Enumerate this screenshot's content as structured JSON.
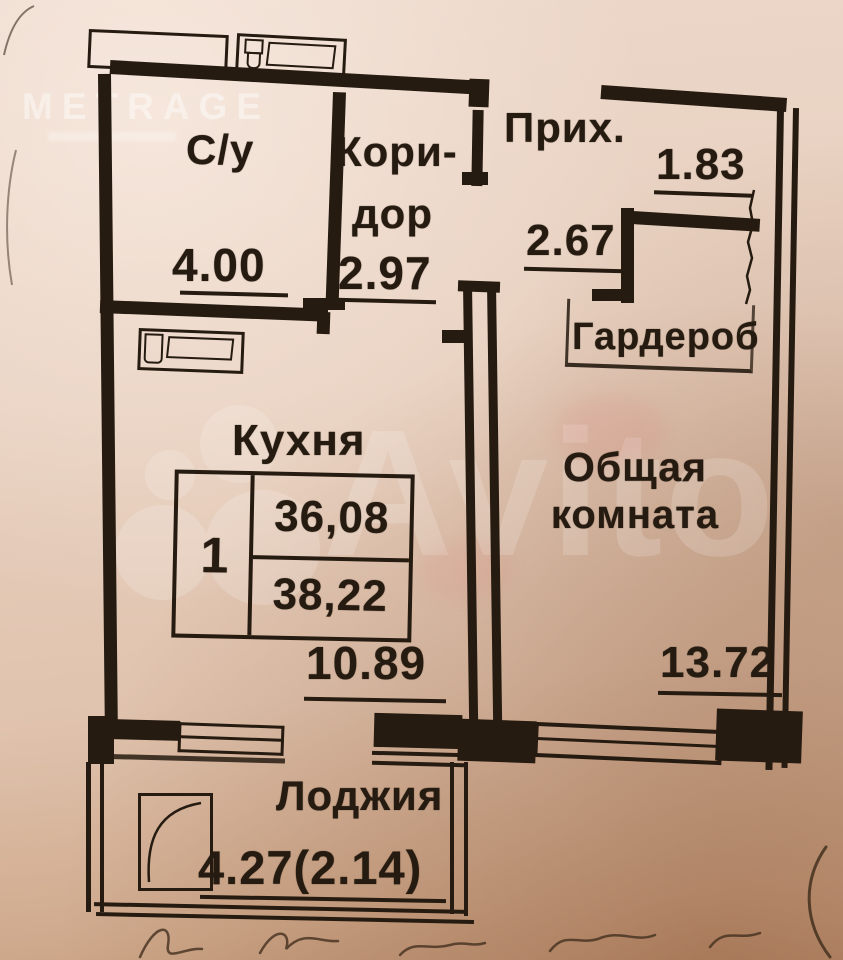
{
  "watermarks": {
    "metrage": "METRAGE",
    "avito": "Avito"
  },
  "rooms": {
    "bathroom": {
      "label": "С/у",
      "dim": "4.00"
    },
    "corridor": {
      "label_line1": "Кори-",
      "label_line2": "дор",
      "dim": "2.97"
    },
    "hallway": {
      "label": "Прих.",
      "dim": "1.83",
      "dim2": "2.67"
    },
    "wardrobe": {
      "label": "Гардероб"
    },
    "kitchen": {
      "label": "Кухня",
      "dim": "10.89"
    },
    "living_room": {
      "label_line1": "Общая",
      "label_line2": "комната",
      "dim": "13.72"
    },
    "loggia": {
      "label": "Лоджия",
      "dim": "4.27(2.14)"
    }
  },
  "info_table": {
    "room_count": "1",
    "value_top": "36,08",
    "value_bottom": "38,22"
  },
  "colors": {
    "ink": "#261b10",
    "paper": "#e7cfbe",
    "watermark": "#ffffff"
  }
}
